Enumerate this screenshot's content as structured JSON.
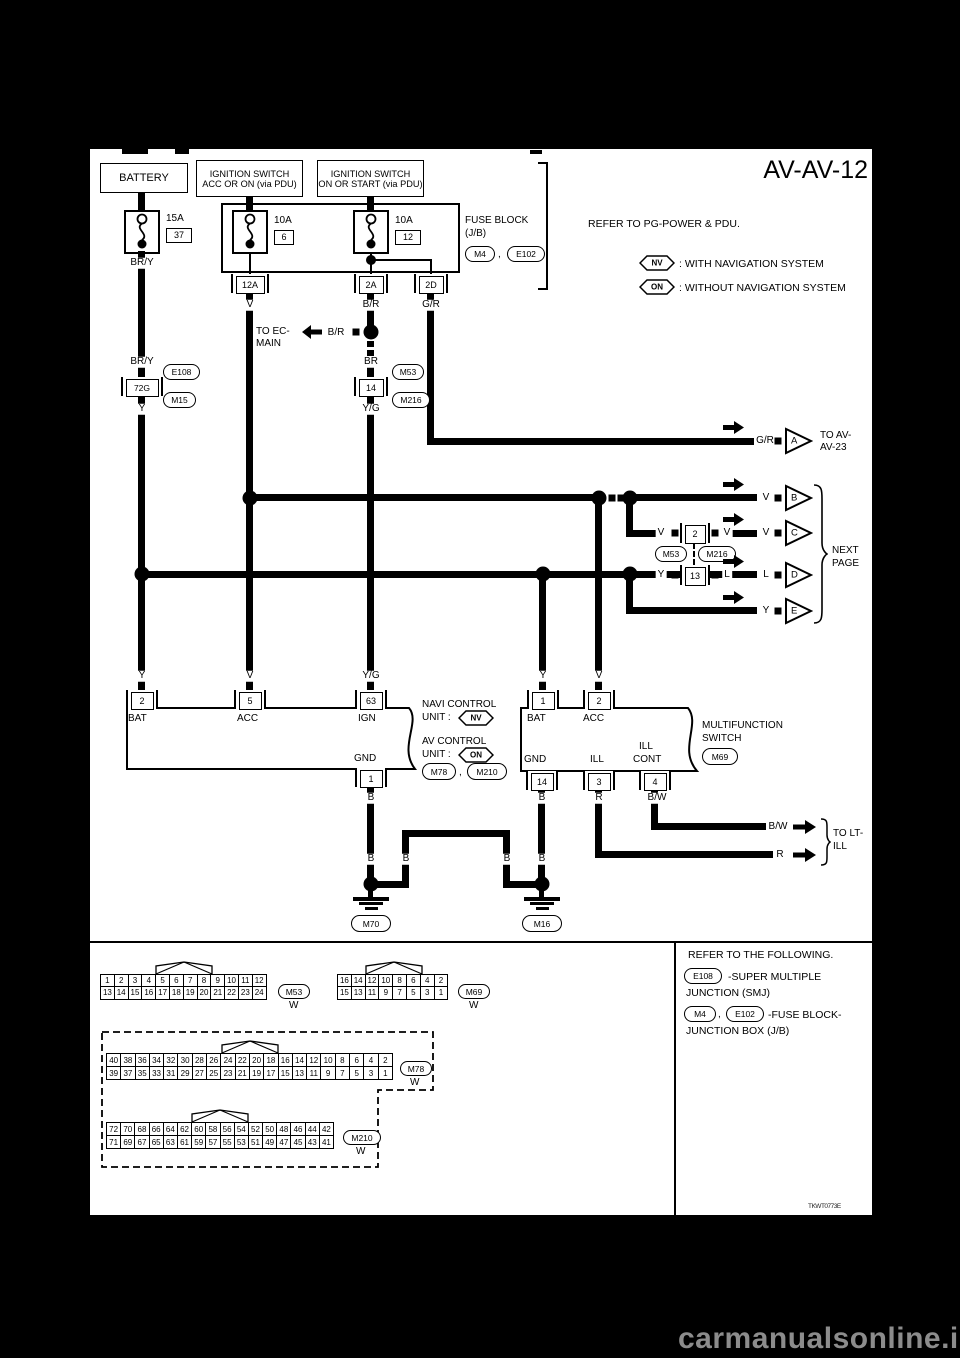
{
  "title": "AV-AV-12",
  "power": {
    "battery": "BATTERY",
    "ign1a": "IGNITION SWITCH",
    "ign1b": "ACC OR ON (via PDU)",
    "ign2a": "IGNITION SWITCH",
    "ign2b": "ON OR START (via PDU)",
    "fuse_block1": "FUSE BLOCK",
    "fuse_block2": "(J/B)",
    "ref_m4": "M4",
    "comma": ",",
    "ref_e102": "E102",
    "refer": "REFER TO PG-POWER & PDU.",
    "nv": "NV",
    "nv_text": ": WITH NAVIGATION SYSTEM",
    "on": "ON",
    "on_text": ": WITHOUT NAVIGATION SYSTEM",
    "f1_amp": "15A",
    "f1_no": "37",
    "f2_amp": "10A",
    "f2_no": "6",
    "f3_amp": "10A",
    "f3_no": "12",
    "out1": "12A",
    "out2": "2A",
    "out3": "2D"
  },
  "wires": {
    "bry1": "BR/Y",
    "v1": "V",
    "br1": "B/R",
    "gr1": "G/R",
    "bry2": "BR/Y",
    "smj": "E108",
    "conn72": "72G",
    "m15": "M15",
    "y1": "Y",
    "ec1": "TO EC-",
    "ec2": "MAIN",
    "ec_br": "B/R",
    "br2": "BR",
    "m53": "M53",
    "conn14": "14",
    "m216": "M216",
    "yg1": "Y/G",
    "gr2": "G/R",
    "tri_a": "A",
    "toav1": "TO AV-",
    "toav2": "AV-23",
    "vb": "V",
    "tri_b": "B",
    "c_v1": "V",
    "c_conn": "2",
    "c_v2": "V",
    "c_m53": "M53",
    "c_m216": "M216",
    "c_v3": "V",
    "tri_c": "C",
    "d_y": "Y",
    "d_conn": "13",
    "d_l1": "L",
    "d_l2": "L",
    "tri_d": "D",
    "e_y": "Y",
    "tri_e": "E",
    "next1": "NEXT",
    "next2": "PAGE",
    "t_y1": "Y",
    "t_v1": "V",
    "t_yg": "Y/G",
    "t_y2": "Y",
    "t_v2": "V"
  },
  "navi": {
    "t_bat": "2",
    "t_acc": "5",
    "t_ign": "63",
    "t_gnd": "1",
    "bat": "BAT",
    "acc": "ACC",
    "ign": "IGN",
    "gnd": "GND",
    "b": "B",
    "n1": "NAVI CONTROL",
    "n1b": "UNIT :",
    "tag1": "NV",
    "n2": "AV CONTROL",
    "n2b": "UNIT :",
    "tag2": "ON",
    "ref1": "M78",
    "comma": ",",
    "ref2": "M210"
  },
  "multi": {
    "t_bat": "1",
    "t_acc": "2",
    "t_gnd": "14",
    "t_ill": "3",
    "t_illc": "4",
    "bat": "BAT",
    "acc": "ACC",
    "gnd": "GND",
    "ill": "ILL",
    "illc1": "ILL",
    "illc2": "CONT",
    "b": "B",
    "r": "R",
    "bw": "B/W",
    "name1": "MULTIFUNCTION",
    "name2": "SWITCH",
    "ref": "M69"
  },
  "ltill": {
    "bw": "B/W",
    "r": "R",
    "to1": "TO LT-",
    "to2": "ILL"
  },
  "gnd": {
    "b1": "B",
    "b2": "B",
    "b3": "B",
    "b4": "B",
    "m70": "M70",
    "m16": "M16"
  },
  "connectors": {
    "m53": {
      "id": "M53",
      "color": "W",
      "rows": [
        [
          1,
          2,
          3,
          4,
          5,
          6,
          7,
          8,
          9,
          10,
          11,
          12
        ],
        [
          13,
          14,
          15,
          16,
          17,
          18,
          19,
          20,
          21,
          22,
          23,
          24
        ]
      ]
    },
    "m69": {
      "id": "M69",
      "color": "W",
      "rows": [
        [
          16,
          14,
          12,
          10,
          8,
          6,
          4,
          2
        ],
        [
          15,
          13,
          11,
          9,
          7,
          5,
          3,
          1
        ]
      ]
    },
    "m78": {
      "id": "M78",
      "color": "W",
      "rows": [
        [
          40,
          38,
          36,
          34,
          32,
          30,
          28,
          26,
          24,
          22,
          20,
          18,
          16,
          14,
          12,
          10,
          8,
          6,
          4,
          2
        ],
        [
          39,
          37,
          35,
          33,
          31,
          29,
          27,
          25,
          23,
          21,
          19,
          17,
          15,
          13,
          11,
          9,
          7,
          5,
          3,
          1
        ]
      ]
    },
    "m210": {
      "id": "M210",
      "color": "W",
      "rows": [
        [
          72,
          70,
          68,
          66,
          64,
          62,
          60,
          58,
          56,
          54,
          52,
          50,
          48,
          46,
          44,
          42
        ],
        [
          71,
          69,
          67,
          65,
          63,
          61,
          59,
          57,
          55,
          53,
          51,
          49,
          47,
          45,
          43,
          41
        ]
      ]
    }
  },
  "legend": {
    "l1": "REFER TO THE FOLLOWING.",
    "smj": "E108",
    "l2": "-SUPER MULTIPLE",
    "l3": "JUNCTION (SMJ)",
    "m4": "M4",
    "comma": ",",
    "e102": "E102",
    "l4": "-FUSE BLOCK-",
    "l5": "JUNCTION BOX (J/B)"
  },
  "code": "TKWT0773E",
  "watermark": "carmanualsonline.info"
}
